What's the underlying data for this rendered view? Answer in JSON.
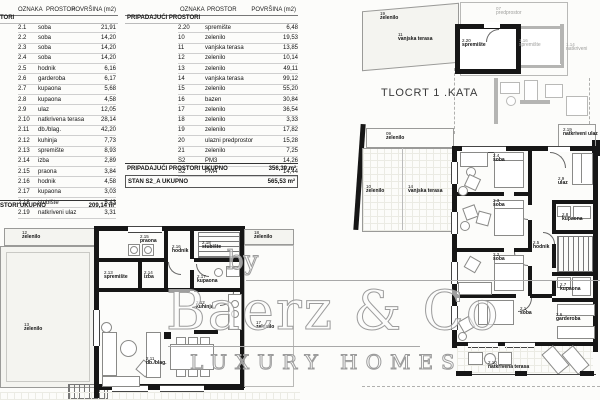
{
  "left_table": {
    "headers": [
      "OZNAKA",
      "PROSTOR",
      "POVRŠINA (m2)"
    ],
    "section_label": "TORI",
    "rows": [
      [
        "2.1",
        "soba",
        "21,91"
      ],
      [
        "2.2",
        "soba",
        "14,20"
      ],
      [
        "2.3",
        "soba",
        "14,20"
      ],
      [
        "2.4",
        "soba",
        "14,20"
      ],
      [
        "2.5",
        "hodnik",
        "6,16"
      ],
      [
        "2.6",
        "garderoba",
        "6,17"
      ],
      [
        "2.7",
        "kupaona",
        "5,68"
      ],
      [
        "2.8",
        "kupaona",
        "4,58"
      ],
      [
        "2.9",
        "ulaz",
        "12,05"
      ],
      [
        "2.10",
        "natkrivena terasa",
        "28,14"
      ],
      [
        "2.11",
        "db./blag.",
        "42,20"
      ],
      [
        "2.12",
        "kuhinja",
        "7,73"
      ],
      [
        "2.13",
        "spremište",
        "8,93"
      ],
      [
        "2.14",
        "izba",
        "2,89"
      ],
      [
        "2.15",
        "praona",
        "3,84"
      ],
      [
        "2.16",
        "hodnik",
        "4,58"
      ],
      [
        "2.17",
        "kupaona",
        "3,03"
      ],
      [
        "2.18",
        "stubište",
        "5,43"
      ],
      [
        "2.19",
        "natkriveni ulaz",
        "3,31"
      ]
    ],
    "total_label": "STORI UKUPNO",
    "total_value": "209,14 m²"
  },
  "middle_table": {
    "headers": [
      "OZNAKA",
      "PROSTOR",
      "POVRŠINA (m2)"
    ],
    "section_label": "PRIPADAJUĆI PROSTORI",
    "rows": [
      [
        "2.20",
        "spremište",
        "6,48"
      ],
      [
        "10",
        "zelenilo",
        "19,53"
      ],
      [
        "11",
        "vanjska terasa",
        "13,85"
      ],
      [
        "12",
        "zelenilo",
        "10,14"
      ],
      [
        "13",
        "zelenilo",
        "49,11"
      ],
      [
        "14",
        "vanjska terasa",
        "99,12"
      ],
      [
        "15",
        "zelenilo",
        "55,20"
      ],
      [
        "16",
        "bazen",
        "30,84"
      ],
      [
        "17",
        "zelenilo",
        "36,54"
      ],
      [
        "18",
        "zelenilo",
        "3,33"
      ],
      [
        "19",
        "zelenilo",
        "17,82"
      ],
      [
        "20",
        "ulazni predprostor",
        "15,28"
      ],
      [
        "21",
        "zelenilo",
        "7,25"
      ],
      [
        "S2",
        "PM3",
        "14,26"
      ],
      [
        "S2",
        "PM4",
        "14,44"
      ]
    ],
    "total_label": "PRIPADAJUĆI PROSTORI UKUPNO",
    "total_value": "356,39 m²",
    "grand_label": "STAN S2_A UKUPNO",
    "grand_value": "565,53 m²"
  },
  "plan_title": "TLOCRT 1 .KATA",
  "watermark": {
    "prefix": "by",
    "name": "Baerz & Co",
    "tagline": "LUXURY HOMES"
  },
  "rooms": {
    "r220": {
      "id": "2.20",
      "name": "spremište"
    },
    "r116": {
      "id": "1.16",
      "name": "spremište"
    },
    "r114": {
      "id": "1.14",
      "name": "natkriveni"
    },
    "pred": {
      "id": "07",
      "name": "predprostor"
    },
    "r24": {
      "id": "2.4",
      "name": "soba"
    },
    "r29": {
      "id": "2.9",
      "name": "ulaz"
    },
    "r219": {
      "id": "2.19",
      "name": "natkriveni ulaz"
    },
    "r23": {
      "id": "2.3",
      "name": "soba"
    },
    "r28": {
      "id": "2.8",
      "name": "kupaona"
    },
    "r25": {
      "id": "2.5",
      "name": "hodnik"
    },
    "r22": {
      "id": "2.2",
      "name": "soba"
    },
    "r27": {
      "id": "2.7",
      "name": "kupaona"
    },
    "r21": {
      "id": "2.1",
      "name": "soba"
    },
    "r26": {
      "id": "2.6",
      "name": "garderoba"
    },
    "r210": {
      "id": "2.10",
      "name": "natkrivena terasa"
    },
    "r215": {
      "id": "2.15",
      "name": "praona"
    },
    "r216": {
      "id": "2.16",
      "name": "hodnik"
    },
    "r218": {
      "id": "2.18",
      "name": "stubište"
    },
    "r213": {
      "id": "2.13",
      "name": "spremište"
    },
    "r214": {
      "id": "2.14",
      "name": "izba"
    },
    "r217": {
      "id": "2.17",
      "name": "kupaona"
    },
    "r212": {
      "id": "2.12",
      "name": "kuhinja"
    },
    "r211": {
      "id": "2.11",
      "name": "db./blag."
    }
  },
  "site": {
    "s19": {
      "id": "19",
      "name": "zelenilo"
    },
    "s11": {
      "id": "11",
      "name": "vanjska terasa"
    },
    "s09": {
      "id": "09",
      "name": "zelenilo"
    },
    "s10": {
      "id": "10",
      "name": "zelenilo"
    },
    "s14": {
      "id": "14",
      "name": "vanjska terasa"
    },
    "s12": {
      "id": "12",
      "name": "zelenilo"
    },
    "s13": {
      "id": "13",
      "name": "zelenilo"
    },
    "s18": {
      "id": "18",
      "name": "zelenilo"
    },
    "s17": {
      "id": "17",
      "name": "zelenilo"
    }
  },
  "colors": {
    "wall": "#161616",
    "gray_wall": "#b5b5b3",
    "row_line": "#cfcfcf",
    "watermark": "#9c9c9c"
  }
}
